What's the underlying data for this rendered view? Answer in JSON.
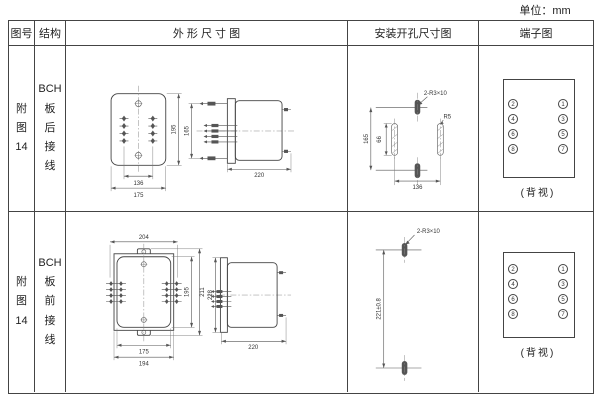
{
  "unit_label": "单位：mm",
  "header": {
    "figure": "图号",
    "structure": "结构",
    "outline": "外 形 尺 寸 图",
    "mounting": "安装开孔尺寸图",
    "terminal": "端子图"
  },
  "rows": [
    {
      "figure": "附\n图\n14",
      "structure": "BCH\n板\n后\n接\n线",
      "outline": {
        "front_height": "195",
        "stud_span": "136",
        "front_width": "175",
        "side_stud_span": "165",
        "depth": "220"
      },
      "mounting": {
        "slots_label": "2-R3×10",
        "radius_label": "R5",
        "vertical_span": "165",
        "slot_length": "66",
        "horizontal_span": "136"
      },
      "terminal": {
        "left": [
          "2",
          "4",
          "6",
          "8"
        ],
        "right": [
          "1",
          "3",
          "5",
          "7"
        ],
        "caption": "(背视)"
      }
    },
    {
      "figure": "附\n图\n14",
      "structure": "BCH\n板\n前\n接\n线",
      "outline": {
        "top_width": "204",
        "panel_height": "195",
        "flange_height": "211",
        "side_height": "228",
        "panel_width": "175",
        "flange_width": "194",
        "depth": "220"
      },
      "mounting": {
        "slots_label": "2-R3×10",
        "vertical_span": "221±0.8"
      },
      "terminal": {
        "left": [
          "2",
          "4",
          "6",
          "8"
        ],
        "right": [
          "1",
          "3",
          "5",
          "7"
        ],
        "caption": "(背视)"
      }
    }
  ]
}
